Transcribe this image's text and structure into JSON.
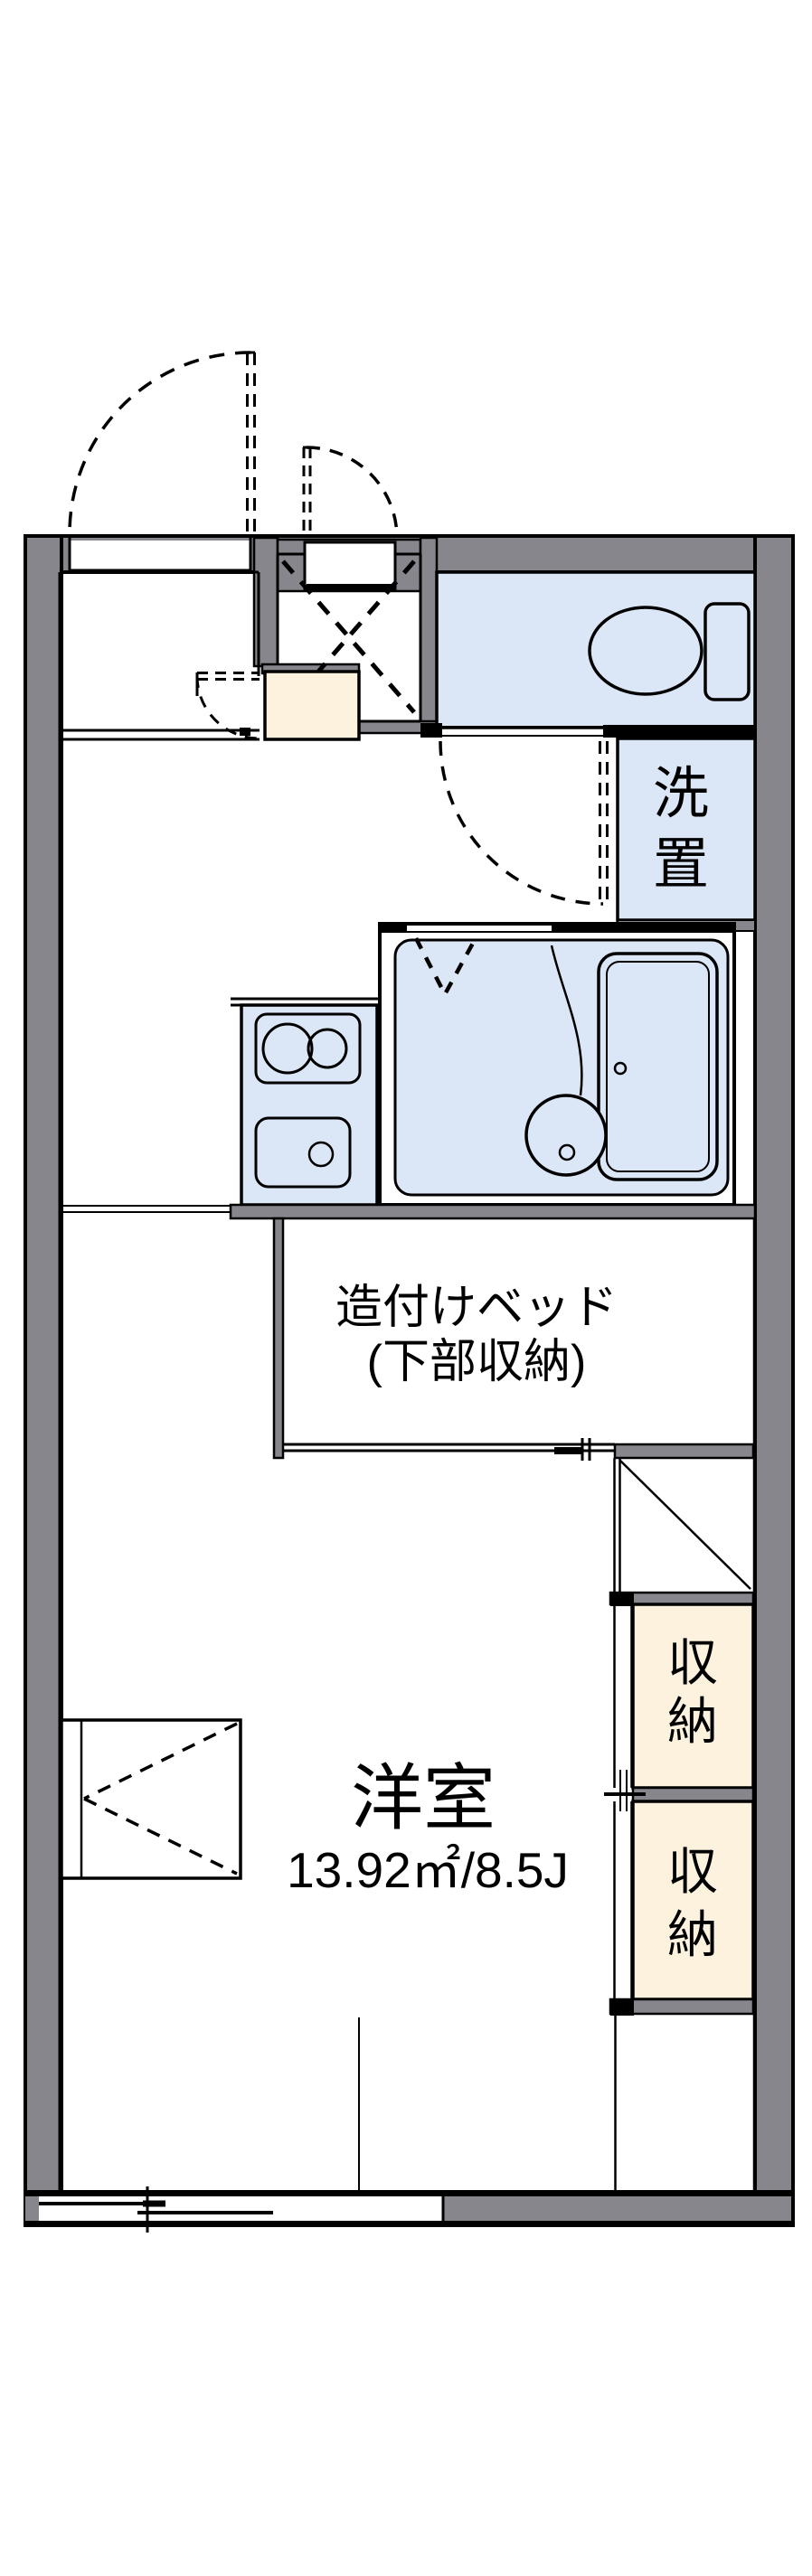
{
  "plan": {
    "rooms": {
      "laundry": {
        "label": "洗置",
        "chars": [
          "洗",
          "置"
        ]
      },
      "bed": {
        "line1": "造付けベッド",
        "line2": "(下部収納)"
      },
      "main_room": {
        "name": "洋室",
        "size": "13.92㎡/8.5J"
      },
      "closet1": {
        "label": "収納",
        "chars": [
          "収",
          "納"
        ]
      },
      "closet2": {
        "label": "収納",
        "chars": [
          "収",
          "納"
        ]
      }
    },
    "colors": {
      "wall": "#86868c",
      "water_area": "#dbe6f6",
      "storage": "#fcf2dd",
      "line": "#000000",
      "background": "#ffffff"
    }
  }
}
